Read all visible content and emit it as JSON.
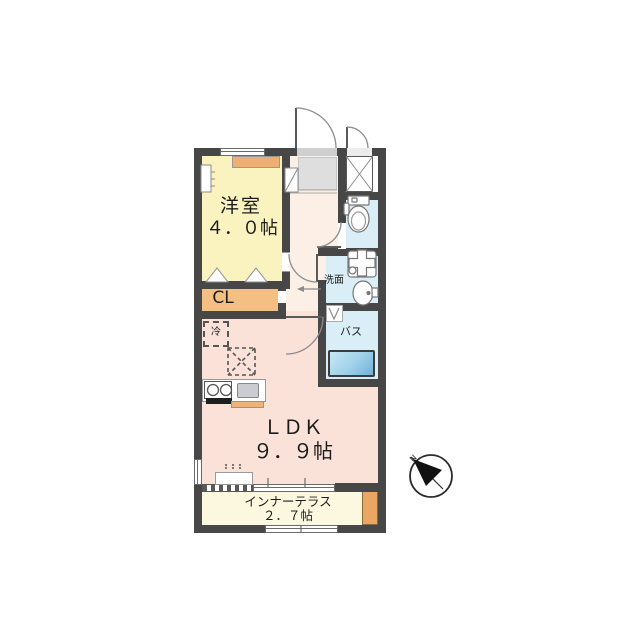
{
  "page": {
    "background": "#ffffff"
  },
  "floor_plan": {
    "type": "apartment-floor-plan-1LDK",
    "rooms": [
      {
        "id": "western_room",
        "label": "洋室",
        "size_label": "４．０帖",
        "color": "#fbf3bf"
      },
      {
        "id": "closet",
        "label": "CL",
        "color": "#f3bf82"
      },
      {
        "id": "ldk",
        "label": "ＬＤＫ",
        "size_label": "９．９帖",
        "color": "#fbe2d8"
      },
      {
        "id": "inner_terrace",
        "label": "インナーテラス",
        "size_label": "２．７帖",
        "color": "#fcf8e0"
      },
      {
        "id": "washroom",
        "label": "洗面",
        "color": "#d9eef7"
      },
      {
        "id": "bath",
        "label": "バス",
        "color": "#d9eef7"
      },
      {
        "id": "toilet",
        "color": "#d9eef7"
      },
      {
        "id": "entrance",
        "color": "#dedede"
      },
      {
        "id": "hallway",
        "color": "#fcf0e6"
      }
    ],
    "annotations": {
      "refrigerator": "冷",
      "compass_north": "N"
    },
    "wall_color": "#474747",
    "accent_orange": "#efae72",
    "tub_gradient": [
      "#c8e7f5",
      "#6fb1d9"
    ]
  }
}
